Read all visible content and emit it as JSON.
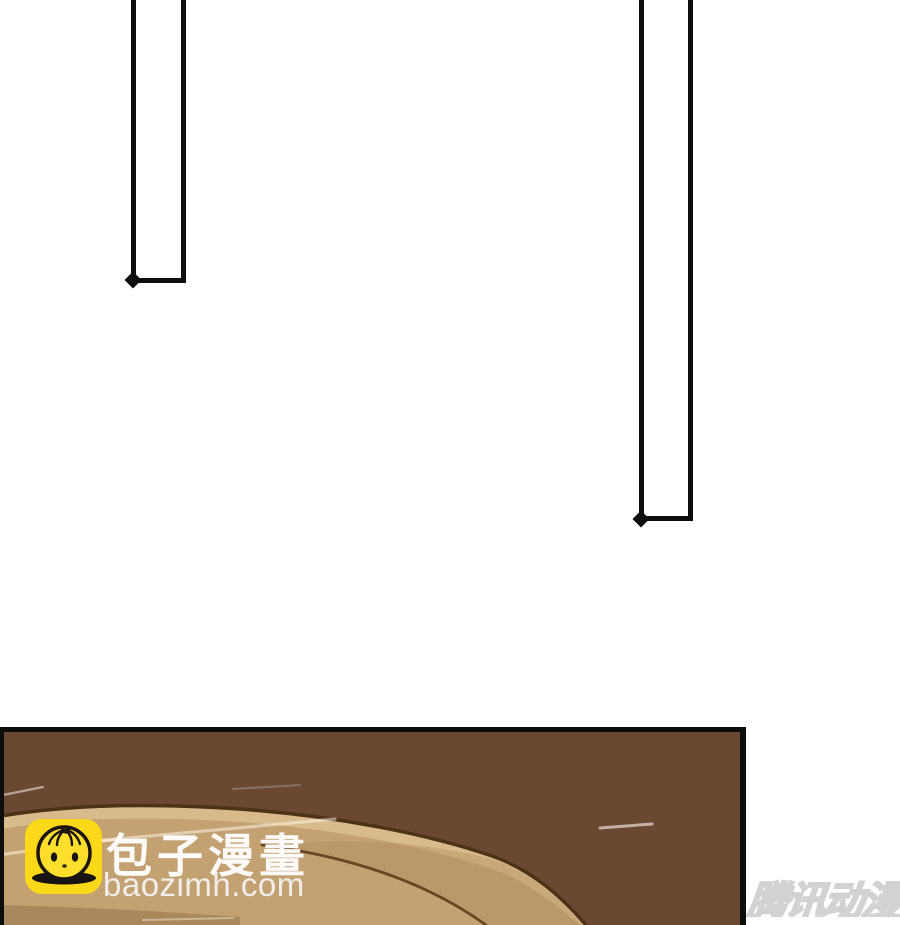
{
  "watermarks": {
    "baozi": {
      "title": "包子漫畫",
      "site": "baozimh.com",
      "icon": "baozi-bun-mascot",
      "icon_bg": "#fcd918",
      "text_color": "#ffffff"
    },
    "tencent": {
      "label": "腾讯动漫",
      "style_color": "#d2d2d2"
    }
  },
  "artwork": {
    "panel_background": "#6a4831",
    "panel_border": "#0d0d0d",
    "table_top": "#c3a170",
    "table_rim_highlight": "#d9bb8b",
    "table_outline": "#4f3118",
    "frame_color": "#0d0d0d"
  }
}
